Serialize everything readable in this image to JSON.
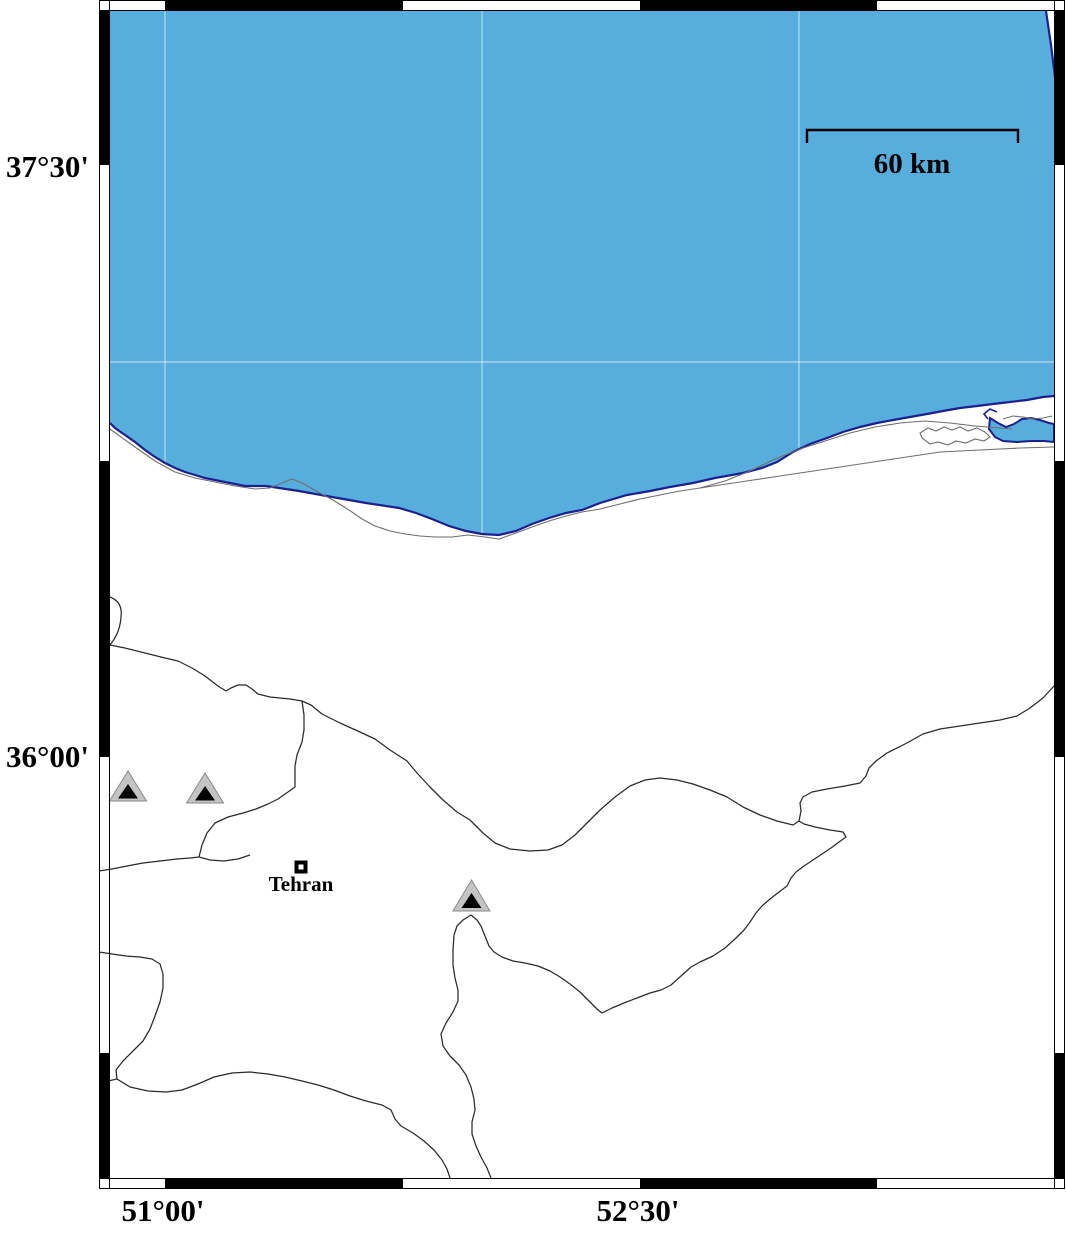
{
  "frame": {
    "lat_labels": [
      {
        "text": "37°30'",
        "tick_y": 165
      },
      {
        "text": "36°00'",
        "tick_y": 757
      }
    ],
    "lon_labels": [
      {
        "text": "51°00'",
        "tick_x": 165
      },
      {
        "text": "52°30'",
        "tick_x": 640
      }
    ]
  },
  "scale_bar": {
    "label": "60 km"
  },
  "city": {
    "name": "Tehran"
  },
  "markers": {
    "triangle_count": 3,
    "city_count": 1
  },
  "colors": {
    "sea": "#57aedd",
    "coastline": "#1b1f8f",
    "grid": "#ffffff",
    "boundary": "#2a2a2a",
    "minor_line": "#6e6e6e",
    "triangle_fill": "#c4c4c4",
    "triangle_outline": "#8a8a8a",
    "frame": "#000000"
  }
}
